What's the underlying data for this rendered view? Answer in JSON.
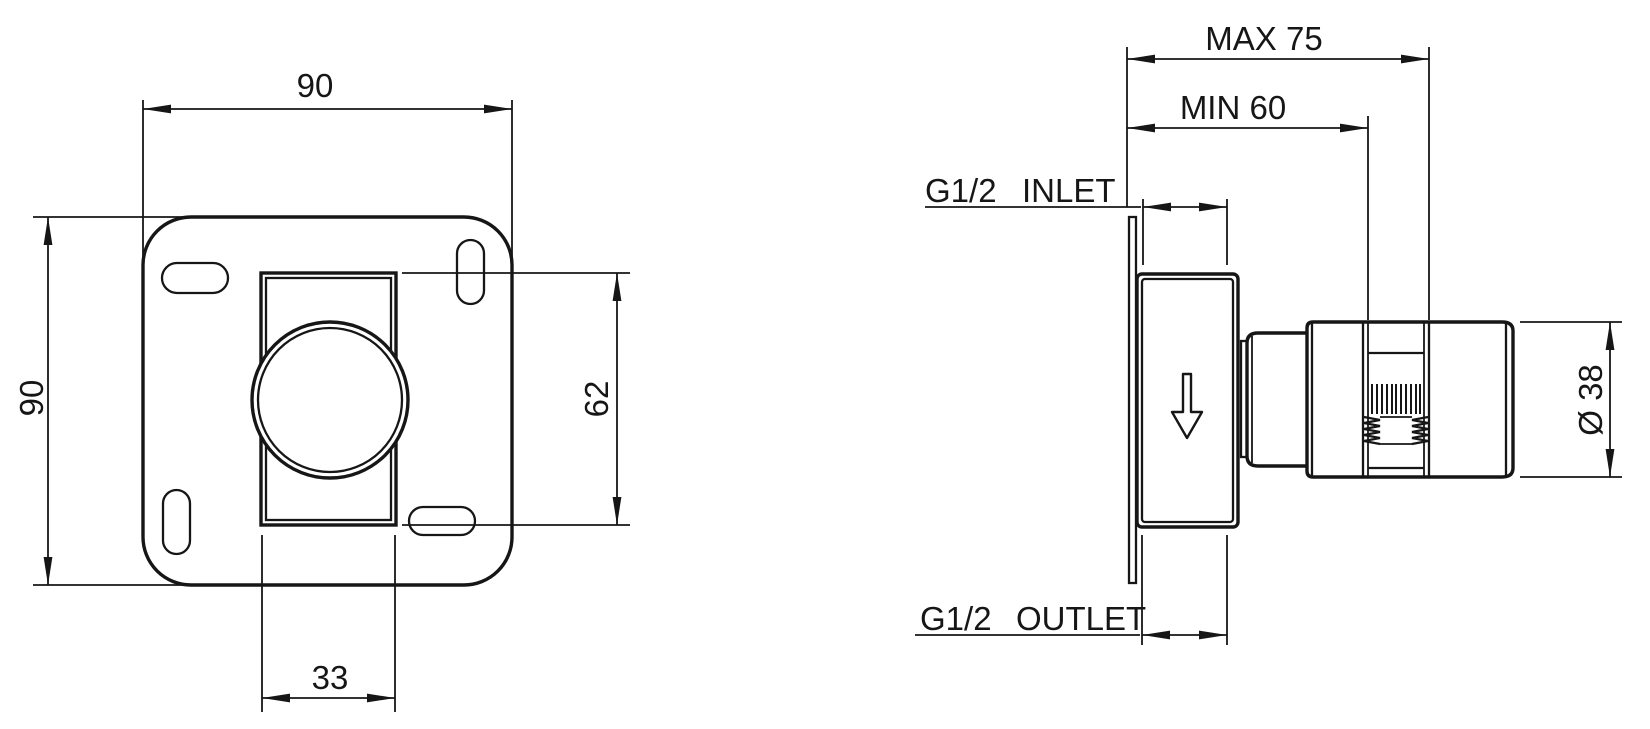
{
  "colors": {
    "ink": "#161616",
    "paper": "#ffffff"
  },
  "front_view": {
    "plate_width": "90",
    "plate_height": "90",
    "cutout_height": "62",
    "cutout_width": "33"
  },
  "side_view": {
    "max_depth": "MAX 75",
    "min_depth": "MIN 60",
    "inlet_thread": "G1/2",
    "inlet_word": "INLET",
    "outlet_thread": "G1/2",
    "outlet_word": "OUTLET",
    "handle_diameter": "Ø 38"
  },
  "icons": {
    "flow_direction_arrow": "down-arrow"
  }
}
